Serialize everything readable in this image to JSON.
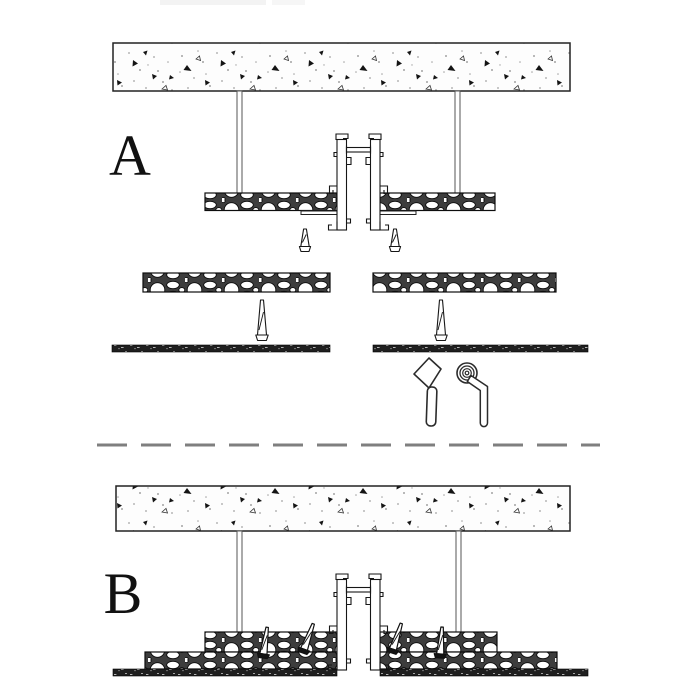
{
  "page": {
    "background": "#ffffff"
  },
  "drawing": {
    "type": "ceiling-installation-detail",
    "sections": {
      "a": {
        "label": "A"
      },
      "b": {
        "label": "B"
      }
    },
    "colors": {
      "line": "#1a1a1a",
      "divider": "#7f7f7f",
      "paper": "#ffffff",
      "letter": "#111111",
      "board_gap": "#3d3d3d",
      "finish_strip": "#1f1f1f"
    },
    "symbols": [
      "concrete-slab-hatch",
      "hanger-rod",
      "recessed-track-profile",
      "aggregate-board",
      "edge-trim",
      "anchor-plug",
      "finish-strip",
      "putty-knife-icon",
      "tape-roll-icon",
      "dashed-section-divider"
    ]
  }
}
